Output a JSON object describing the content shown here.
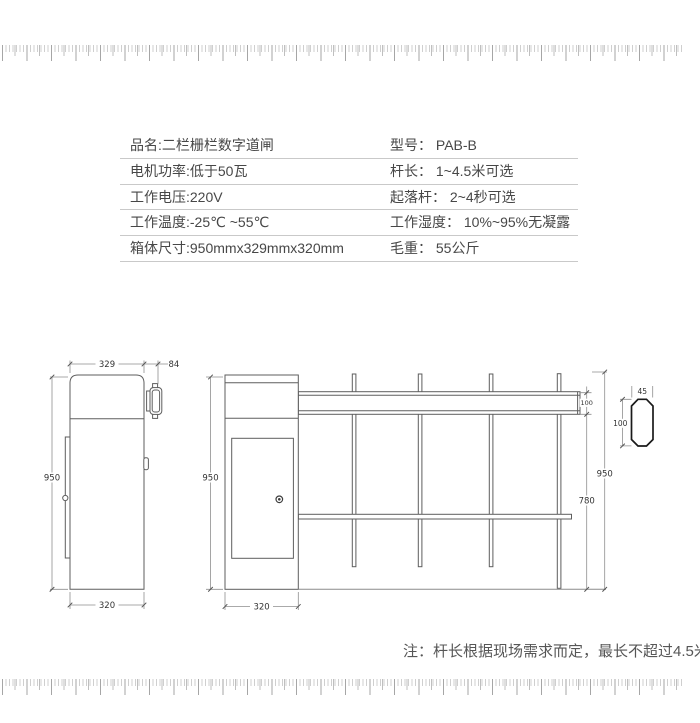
{
  "spec_table": {
    "rows": [
      {
        "left": "品名:二栏栅栏数字道闸",
        "right": "型号： PAB-B"
      },
      {
        "left": "电机功率:低于50瓦",
        "right": "杆长： 1~4.5米可选"
      },
      {
        "left": "工作电压:220V",
        "right": "起落杆： 2~4秒可选"
      },
      {
        "left": "工作温度:-25℃ ~55℃",
        "right": "工作湿度： 10%~95%无凝露"
      },
      {
        "left": "箱体尺寸:950mmx329mmx320mm",
        "right": "毛重： 55公斤"
      }
    ]
  },
  "drawings": {
    "side_view": {
      "top_width": "329",
      "bracket_offset": "84",
      "height": "950",
      "bottom_width": "320"
    },
    "front_view": {
      "left_height": "950",
      "cabinet_width": "320",
      "arm_height": "100",
      "fence_height": "780",
      "total_height": "950"
    },
    "cross_section": {
      "width": "45",
      "height": "100"
    },
    "note": "注：杆长根据现场需求而定，最长不超过4.5米"
  },
  "colors": {
    "table_line": "#c9c9c9",
    "text": "#474747",
    "drawing_stroke": "#5e5e5e",
    "ruler_tick": "#bfbfbf"
  }
}
